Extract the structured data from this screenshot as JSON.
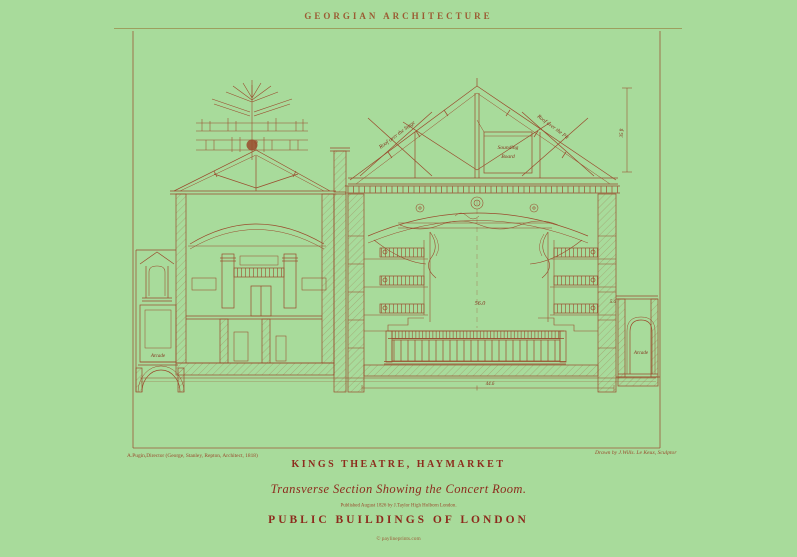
{
  "poster": {
    "header": "GEORGIAN ARCHITECTURE",
    "credits": {
      "left": "A.Pugin,Director (George, Stanley, Repton, Architect, 1818)",
      "right": "Drawn by J.Wills. Le Keux, Sculptor"
    },
    "footer": {
      "title": "KINGS THEATRE, HAYMARKET",
      "subtitle": "Transverse Section Showing the Concert Room.",
      "imprint": "Published August 1826 by J.Taylor High Holborn London.",
      "series": "PUBLIC BUILDINGS OF LONDON",
      "copyright": "© paylineprints.com"
    },
    "drawing_labels": {
      "roof_left": "Roof over the Stage",
      "roof_right": "Roof over the Pit",
      "sounding_1": "Sounding",
      "sounding_2": "Board",
      "dim_roof_height": "35 ft",
      "dim_hall": "56.0",
      "dim_base": "44.6",
      "dim_wing": "5.6",
      "arcade_left": "Arcade",
      "arcade_right": "Arcade"
    },
    "colors": {
      "background": "#a8db9b",
      "ink": "#9a4a2c",
      "ink-strong": "#84301c",
      "title": "#8d2b1d",
      "header": "#9b5b33",
      "rule": "#9b9455"
    }
  }
}
